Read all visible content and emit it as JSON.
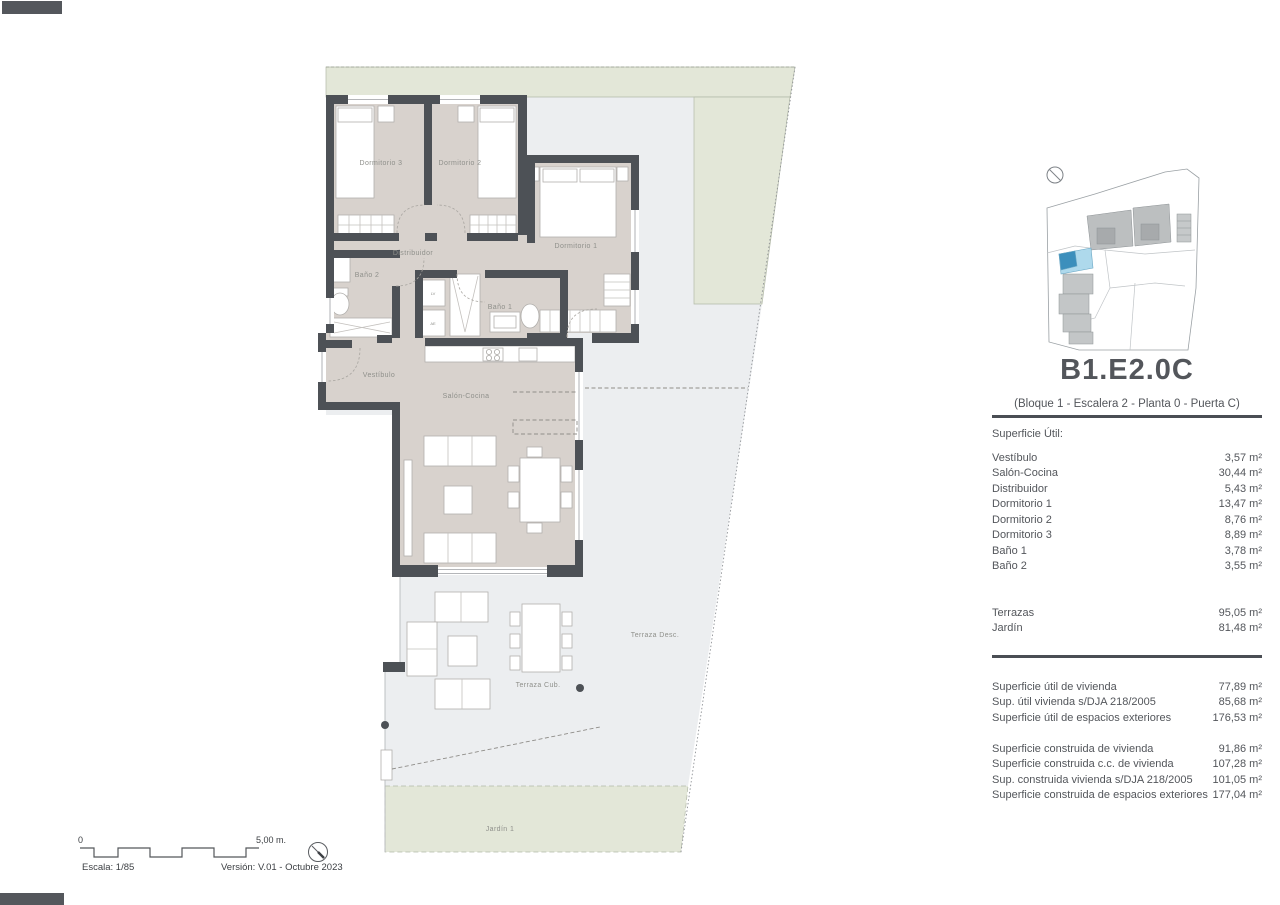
{
  "colors": {
    "wall": "#4d5156",
    "room_fill": "#d8d2cd",
    "terrace_fill": "#eceef0",
    "green_fill": "#e3e7d8",
    "highlight_blue_light": "#aed9ec",
    "highlight_blue_dark": "#3c8fbc",
    "text": "#54575c"
  },
  "floor_plan": {
    "labels": {
      "dormitorio3": "Dormitorio 3",
      "dormitorio2": "Dormitorio 2",
      "dormitorio1": "Dormitorio 1",
      "distribuidor": "Distribuidor",
      "bano2": "Baño 2",
      "bano1": "Baño 1",
      "vestibulo": "Vestíbulo",
      "salon_cocina": "Salón-Cocina",
      "terraza_cub": "Terraza Cub.",
      "terraza_desc": "Terraza Desc.",
      "jardin": "Jardín 1",
      "util_closet_1": "LV",
      "util_closet_2": "AE"
    }
  },
  "panel": {
    "title": "B1.E2.0C",
    "subtitle": "(Bloque 1 - Escalera 2 - Planta 0 - Puerta C)",
    "util_heading": "Superficie Útil:",
    "util_rows": [
      {
        "label": "Vestíbulo",
        "value": "3,57 m²"
      },
      {
        "label": "Salón-Cocina",
        "value": "30,44 m²"
      },
      {
        "label": "Distribuidor",
        "value": "5,43 m²"
      },
      {
        "label": "Dormitorio 1",
        "value": "13,47 m²"
      },
      {
        "label": "Dormitorio 2",
        "value": "8,76 m²"
      },
      {
        "label": "Dormitorio 3",
        "value": "8,89 m²"
      },
      {
        "label": "Baño 1",
        "value": "3,78 m²"
      },
      {
        "label": "Baño 2",
        "value": "3,55 m²"
      }
    ],
    "exterior_rows": [
      {
        "label": "Terrazas",
        "value": "95,05 m²"
      },
      {
        "label": "Jardín",
        "value": "81,48 m²"
      }
    ],
    "summary_util_rows": [
      {
        "label": "Superficie útil de vivienda",
        "value": "77,89 m²"
      },
      {
        "label": "Sup. útil vivienda s/DJA 218/2005",
        "value": "85,68 m²"
      },
      {
        "label": "Superficie útil de espacios exteriores",
        "value": "176,53 m²"
      }
    ],
    "summary_built_rows": [
      {
        "label": "Superficie construida de vivienda",
        "value": "91,86 m²"
      },
      {
        "label": "Superficie construida c.c. de vivienda",
        "value": "107,28 m²"
      },
      {
        "label": "Sup. construida vivienda s/DJA 218/2005",
        "value": "101,05 m²"
      },
      {
        "label": "Superficie construida de espacios exteriores",
        "value": "177,04 m²"
      }
    ]
  },
  "footer": {
    "scale_start": "0",
    "scale_end": "5,00 m.",
    "escala": "Escala: 1/85",
    "version": "Versión: V.01 - Octubre 2023"
  }
}
